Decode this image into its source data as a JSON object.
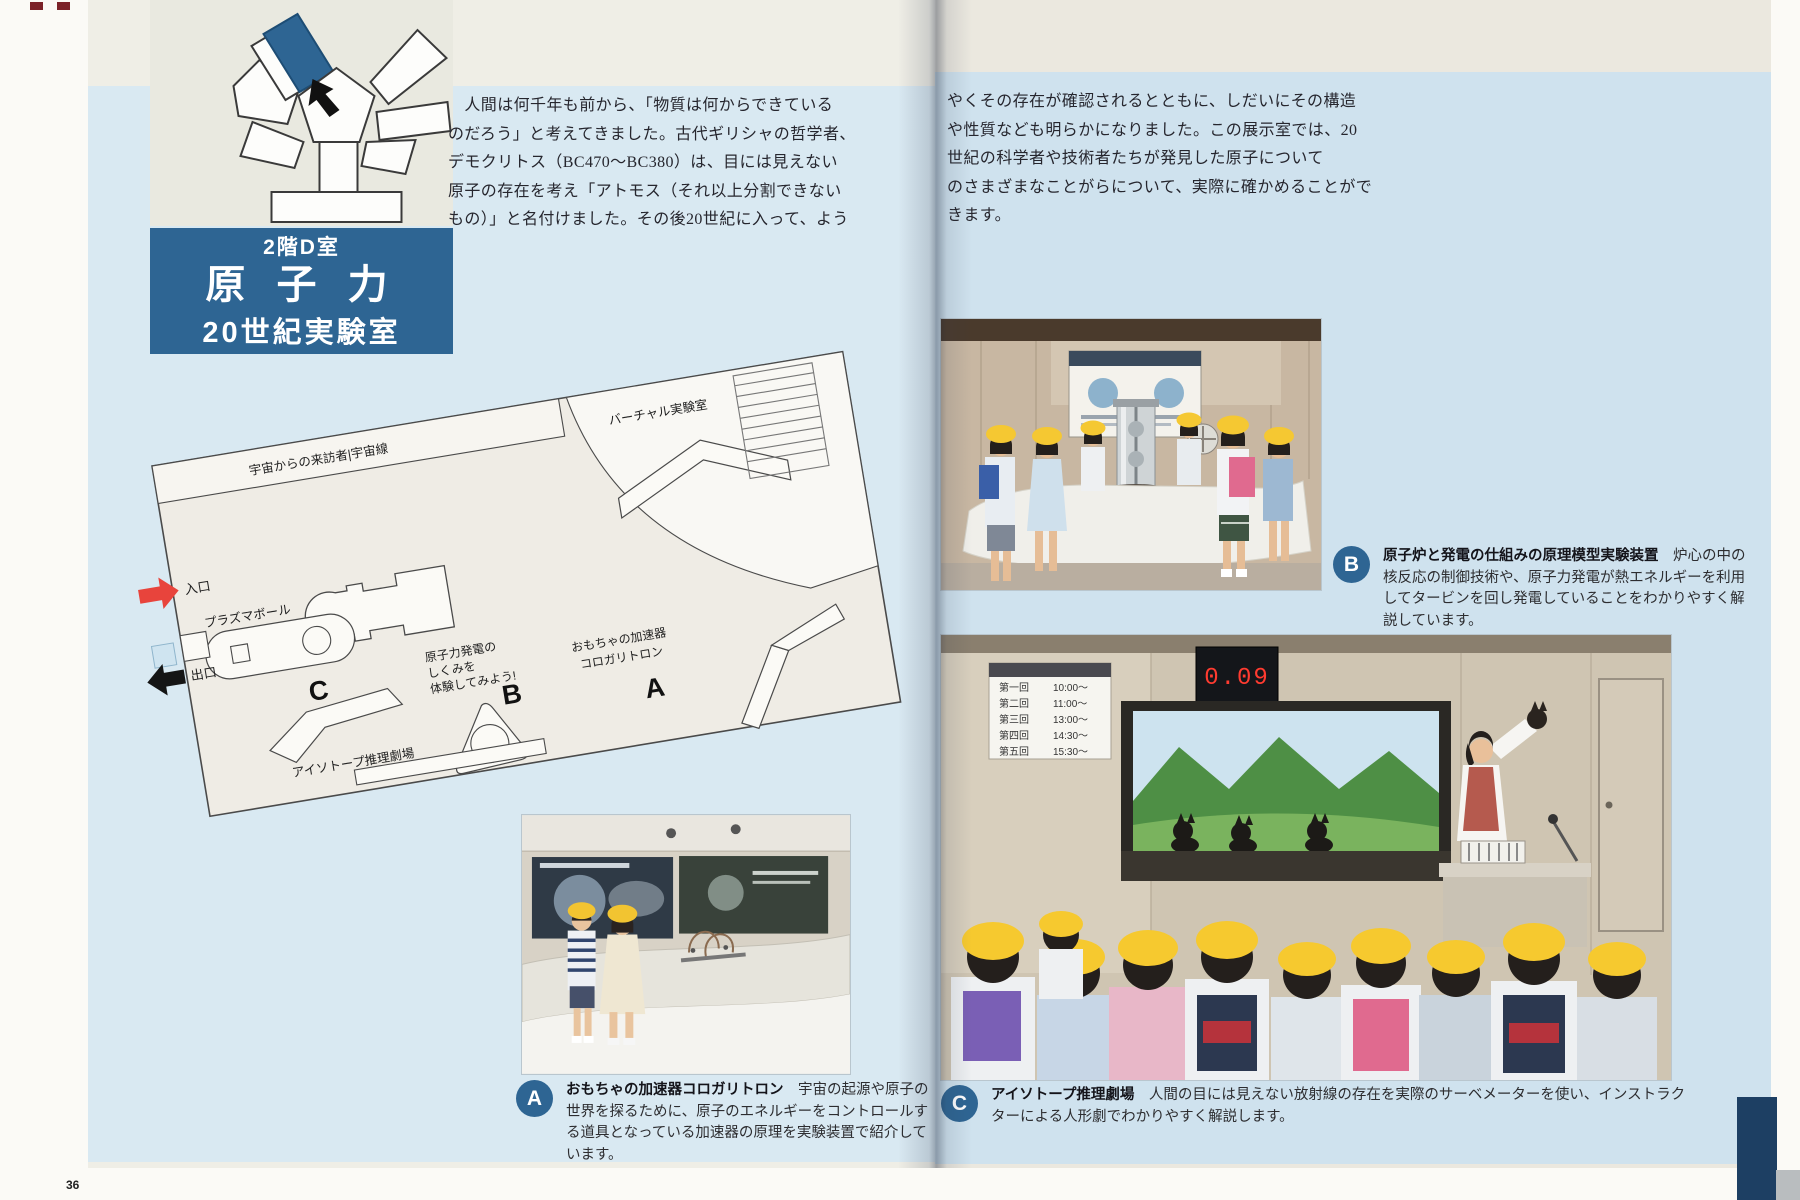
{
  "meta": {
    "page_number": "36"
  },
  "header": {
    "floor": "2階D室",
    "title": "原 子 力",
    "subtitle": "20世紀実験室"
  },
  "intro": {
    "left": "　人間は何千年も前から、「物質は何からできている\nのだろう」と考えてきました。古代ギリシャの哲学者、\nデモクリトス（BC470～BC380）は、目には見えない\n原子の存在を考え「アトモス（それ以上分割できない\nもの）」と名付けました。その後20世紀に入って、よう",
    "right": "やくその存在が確認されるとともに、しだいにその構造\nや性質なども明らかになりました。この展示室では、20\n世紀の科学者や技術者たちが発見した原子について\nのさまざまなことがらについて、実際に確かめることがで\nきます。"
  },
  "map": {
    "labels": {
      "cosmic": "宇宙からの来訪者|宇宙線",
      "virtual_lab": "バーチャル実験室",
      "entrance": "入口",
      "plasma_ball": "プラズマボール",
      "exit": "出口",
      "exhibit_b_line1": "原子力発電の",
      "exhibit_b_line2": "しくみを",
      "exhibit_b_line3": "体験してみよう!",
      "exhibit_a_line1": "おもちゃの加速器",
      "exhibit_a_line2": "コロガリトロン",
      "isotope_theater": "アイソトープ推理劇場",
      "marker_a": "A",
      "marker_b": "B",
      "marker_c": "C"
    }
  },
  "captions": {
    "a": {
      "marker": "A",
      "title": "おもちゃの加速器コロガリトロン",
      "body": "　宇宙の起源や原子の世界を探るために、原子のエネルギーをコントロールする道具となっている加速器の原理を実験装置で紹介しています。"
    },
    "b": {
      "marker": "B",
      "title": "原子炉と発電の仕組みの原理模型実験装置",
      "body": "　炉心の中の核反応の制御技術や、原子力発電が熱エネルギーを利用してタービンを回し発電していることをわかりやすく解説しています。"
    },
    "c": {
      "marker": "C",
      "title": "アイソトープ推理劇場",
      "body": "　人間の目には見えない放射線の存在を実際のサーベメーターを使い、インストラクターによる人形劇でわかりやすく解説します。"
    }
  },
  "photo_c": {
    "schedule": {
      "rows": [
        {
          "label": "第一回",
          "time": "10:00～"
        },
        {
          "label": "第二回",
          "time": "11:00～"
        },
        {
          "label": "第三回",
          "time": "13:00～"
        },
        {
          "label": "第四回",
          "time": "14:30～"
        },
        {
          "label": "第五回",
          "time": "15:30～"
        }
      ]
    },
    "clock": "0.09"
  },
  "colors": {
    "accent_blue": "#2e6593",
    "entrance_red": "#e8443c",
    "hat_yellow": "#f5c82e",
    "page_blue_left": "#d9e9f2",
    "page_blue_right": "#cfe2ee"
  }
}
